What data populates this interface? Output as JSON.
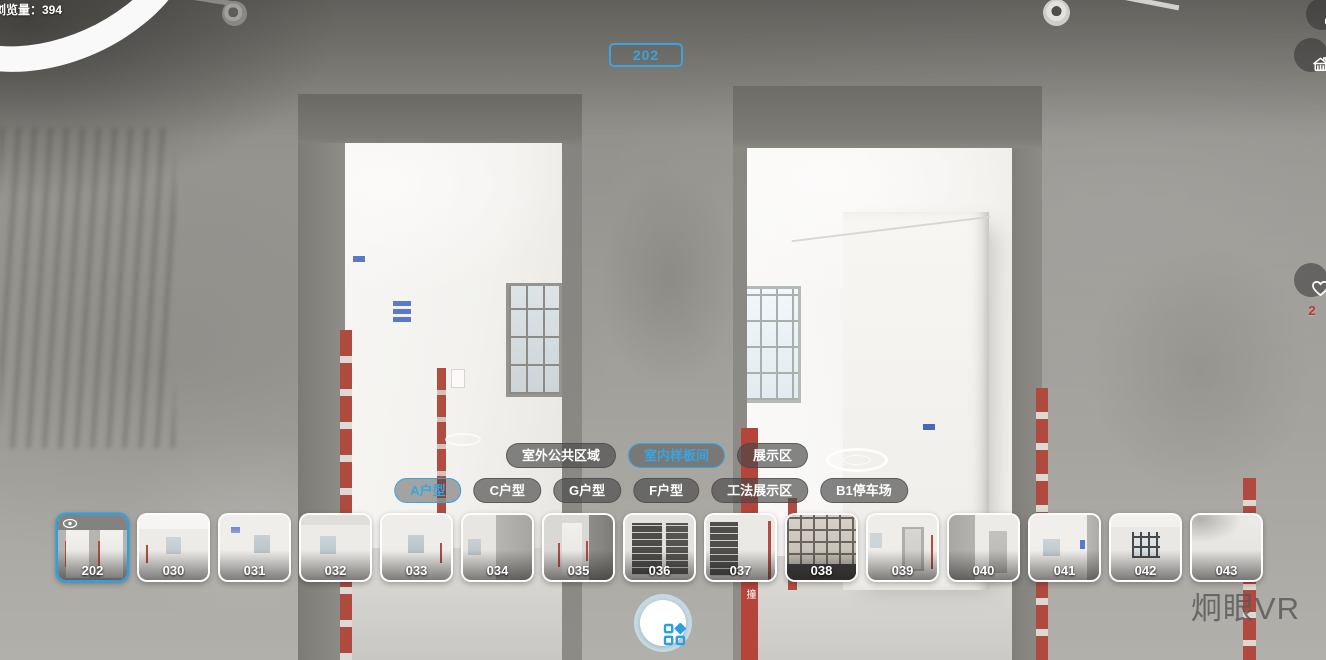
{
  "viewer": {
    "view_count": "浏览量：394",
    "scene_badge": "202",
    "favorite_count": "2",
    "watermark": "炯眼VR",
    "accent_color": "#35a6e4"
  },
  "scene": {
    "floor_sign": "小心碰撞"
  },
  "category_tabs": [
    {
      "label": "室外公共区域",
      "active": false
    },
    {
      "label": "室内样板间",
      "active": true
    },
    {
      "label": "展示区",
      "active": false
    }
  ],
  "unit_tabs": [
    {
      "label": "A户型",
      "active": true
    },
    {
      "label": "C户型",
      "active": false
    },
    {
      "label": "G户型",
      "active": false
    },
    {
      "label": "F户型",
      "active": false
    },
    {
      "label": "工法展示区",
      "active": false
    },
    {
      "label": "B1停车场",
      "active": false
    }
  ],
  "thumbnails": [
    {
      "label": "202",
      "selected": true,
      "variant": "v202"
    },
    {
      "label": "030",
      "selected": false,
      "variant": "v030"
    },
    {
      "label": "031",
      "selected": false,
      "variant": "v031"
    },
    {
      "label": "032",
      "selected": false,
      "variant": "v032"
    },
    {
      "label": "033",
      "selected": false,
      "variant": "v033"
    },
    {
      "label": "034",
      "selected": false,
      "variant": "v034"
    },
    {
      "label": "035",
      "selected": false,
      "variant": "v035"
    },
    {
      "label": "036",
      "selected": false,
      "variant": "v036"
    },
    {
      "label": "037",
      "selected": false,
      "variant": "v037"
    },
    {
      "label": "038",
      "selected": false,
      "variant": "v038"
    },
    {
      "label": "039",
      "selected": false,
      "variant": "v039"
    },
    {
      "label": "040",
      "selected": false,
      "variant": "v040"
    },
    {
      "label": "041",
      "selected": false,
      "variant": "v041"
    },
    {
      "label": "042",
      "selected": false,
      "variant": "v042"
    },
    {
      "label": "043",
      "selected": false,
      "variant": "v043"
    }
  ]
}
